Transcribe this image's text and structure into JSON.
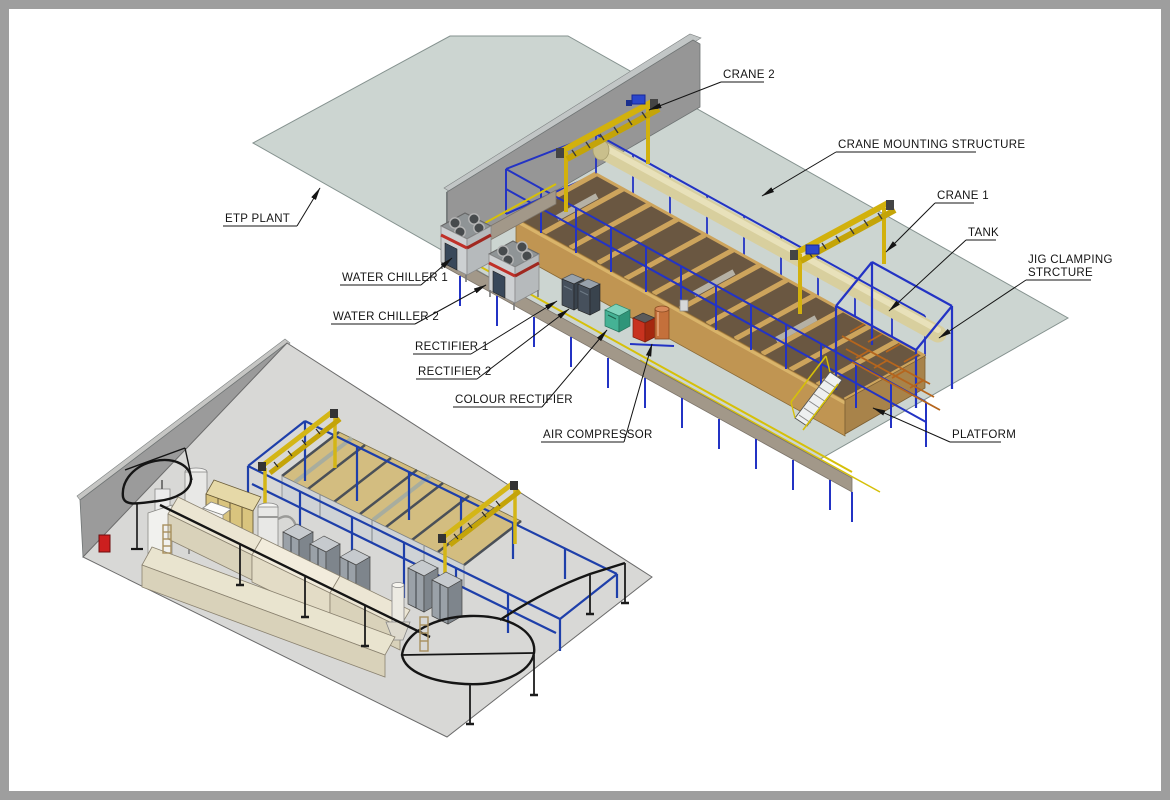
{
  "drawing": {
    "type": "isometric-plant-layout",
    "views": [
      "main-process-tank-line",
      "secondary-coating-plant"
    ]
  },
  "annotations": {
    "crane_2": {
      "text": "CRANE 2"
    },
    "crane_mounting_structure": {
      "text": "CRANE MOUNTING STRUCTURE"
    },
    "crane_1": {
      "text": "CRANE 1"
    },
    "tank": {
      "text": "TANK"
    },
    "jig_clamping_1": {
      "text": "JIG CLAMPING"
    },
    "jig_clamping_2": {
      "text": "STRCTURE"
    },
    "platform": {
      "text": "PLATFORM"
    },
    "etp_plant": {
      "text": "ETP PLANT"
    },
    "water_chiller_1": {
      "text": "WATER CHILLER 1"
    },
    "water_chiller_2": {
      "text": "WATER CHILLER 2"
    },
    "rectifier_1": {
      "text": "RECTIFIER 1"
    },
    "rectifier_2": {
      "text": "RECTIFIER 2"
    },
    "colour_rectifier": {
      "text": "COLOUR RECTIFIER"
    },
    "air_compressor": {
      "text": "AIR COMPRESSOR"
    }
  },
  "colors": {
    "frame_border": "#9e9e9e",
    "floor_main": "#ccd5d1",
    "floor_small": "#d8d8d6",
    "wall": "#969696",
    "tank_tan": "#c09552",
    "tank_interior": "#6a5741",
    "structure_blue": "#2333c4",
    "crane_yellow": "#d2b10d",
    "walkway_gray": "#a29889",
    "rail_yellow": "#d6c009",
    "jig_orange": "#b5651d",
    "chiller_stripe_red": "#c03028",
    "rectifier_slate": "#46505c",
    "colour_rectifier_teal": "#45b295",
    "compressor_red": "#c8331f",
    "compressor_tank_orange": "#c4703b",
    "safety_box_red": "#cc1f1f",
    "annotation_line": "#141414"
  }
}
